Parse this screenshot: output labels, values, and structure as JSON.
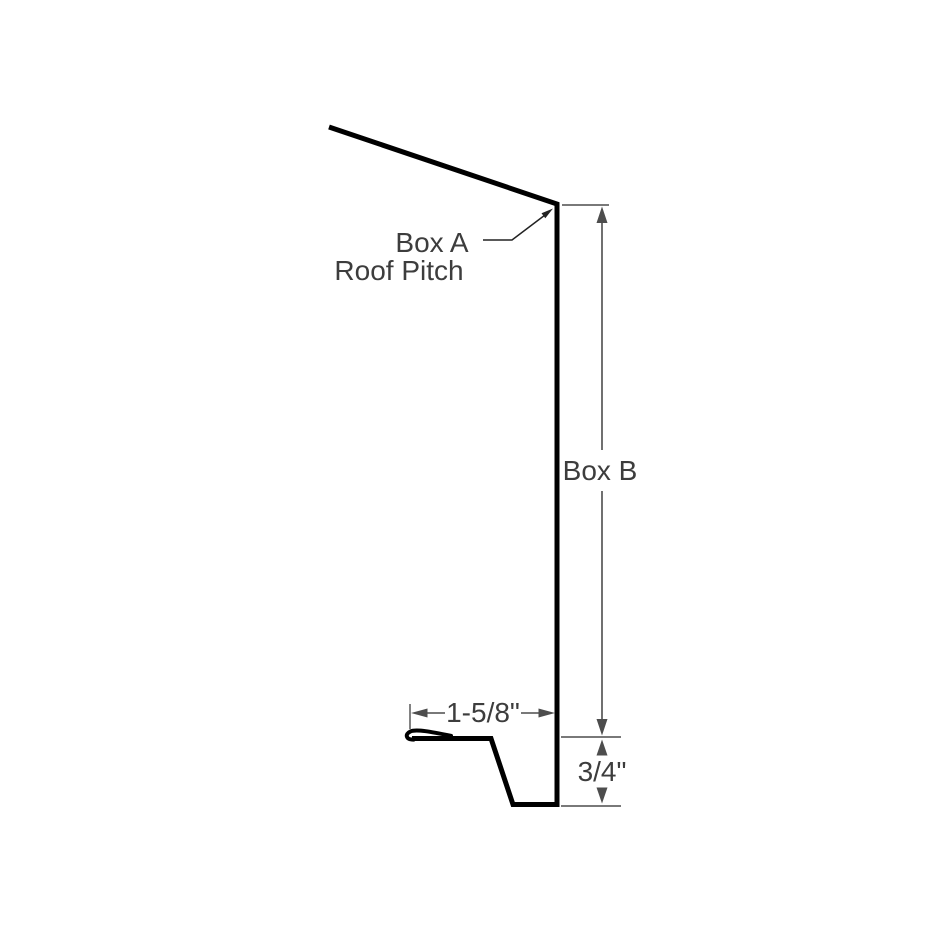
{
  "colors": {
    "background": "#ffffff",
    "profile": "#000000",
    "dimension": "#4d4d4d",
    "text": "#3d3d3d",
    "leader": "#222222"
  },
  "callout": {
    "line1": "Box A",
    "line2": "Roof Pitch"
  },
  "dimensions": {
    "height_label": "Box B",
    "flange_width": "1-5/8\"",
    "kick_height": "3/4\""
  }
}
